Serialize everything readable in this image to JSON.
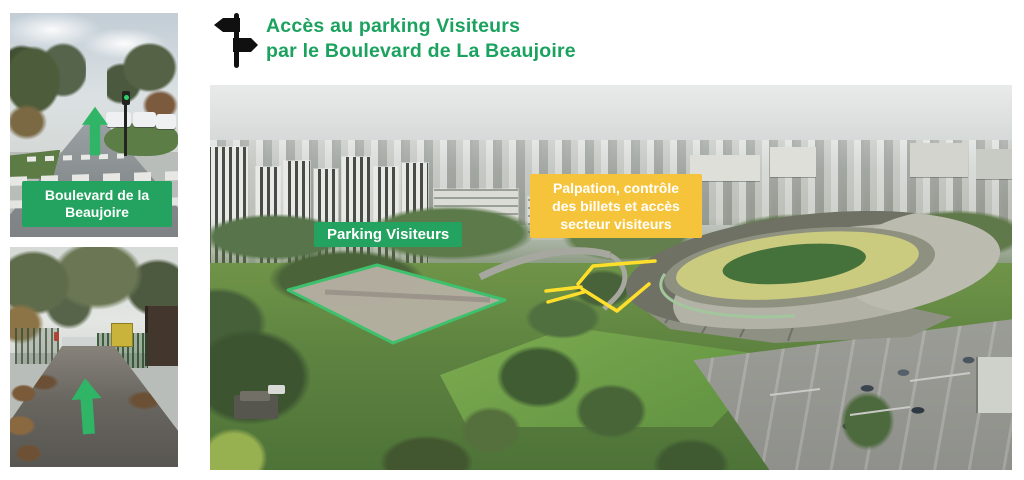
{
  "header": {
    "title_lines": [
      "Accès au parking Visiteurs",
      "par le Boulevard de La Beaujoire"
    ],
    "title_color": "#1ba25e"
  },
  "photos": {
    "street": {
      "label": "Boulevard de la Beaujoire"
    },
    "gate": {}
  },
  "aerial": {
    "parking_label": "Parking Visiteurs",
    "security_label_lines": [
      "Palpation, contrôle",
      "des billets et accès",
      "secteur visiteurs"
    ]
  },
  "icons": {
    "header": "signpost-icon",
    "street_photo": "up-arrow-icon",
    "gate_photo": "up-arrow-icon"
  },
  "colors": {
    "green_label": "#23a35f",
    "yellow_label": "#f6c43b",
    "arrow_green": "#2fb565",
    "route_yellow": "#ffdf2b",
    "outline_green": "#3ec06c",
    "icon_black": "#101010"
  }
}
